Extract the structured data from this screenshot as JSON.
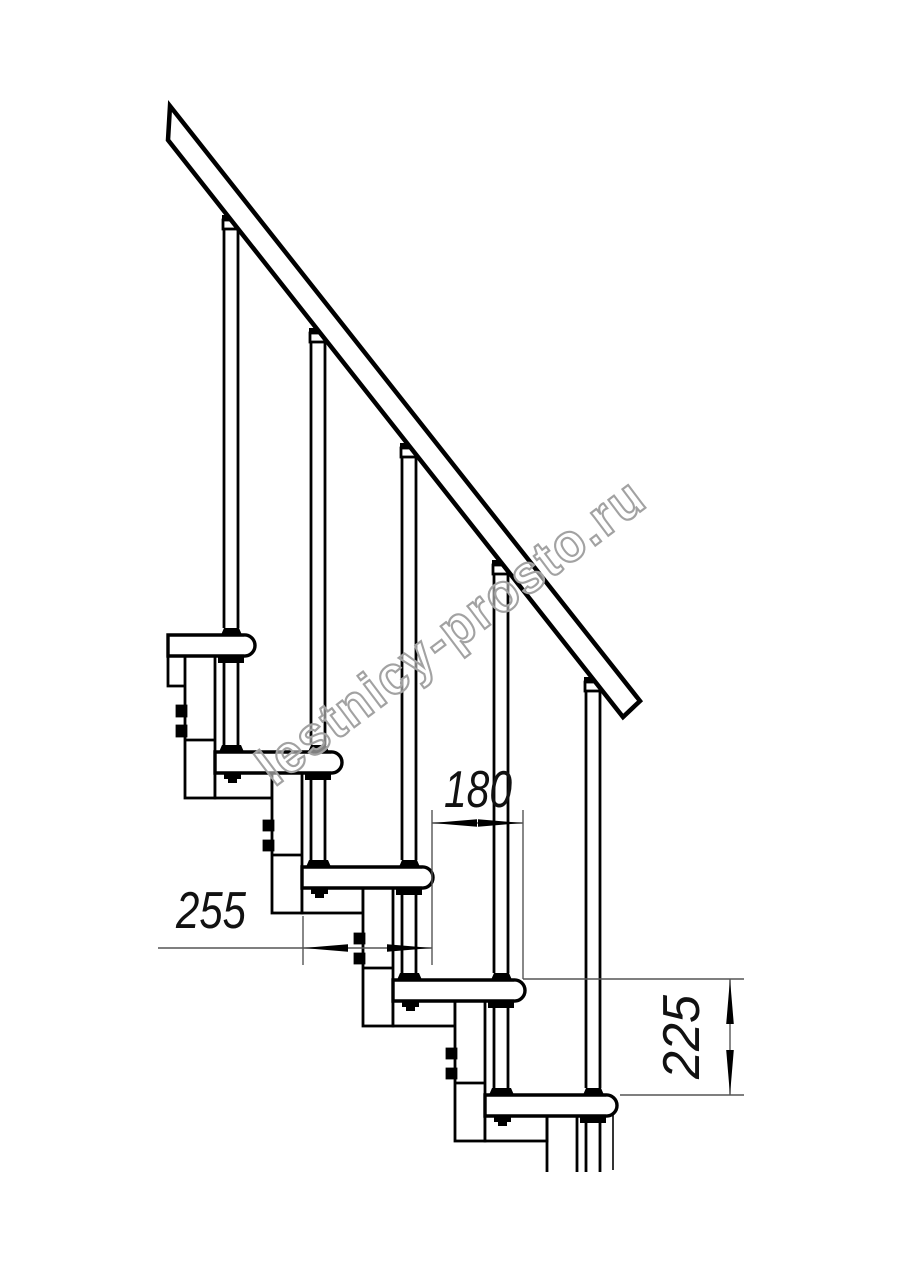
{
  "drawing": {
    "type": "staircase-side-elevation",
    "steps_visible": 5,
    "has_handrail": true
  },
  "dimensions": [
    {
      "id": "step-run",
      "label": "180"
    },
    {
      "id": "tread-depth",
      "label": "255"
    },
    {
      "id": "step-rise",
      "label": "225"
    }
  ],
  "watermark": {
    "text": "lestnicy-prosto.ru"
  },
  "colors": {
    "outline": "#000000",
    "thin": "#555555",
    "dim_text": "#111111",
    "watermark_stroke": "#a2a2a2",
    "watermark_fill": "rgba(255,255,255,0.5)",
    "background": "#ffffff"
  }
}
